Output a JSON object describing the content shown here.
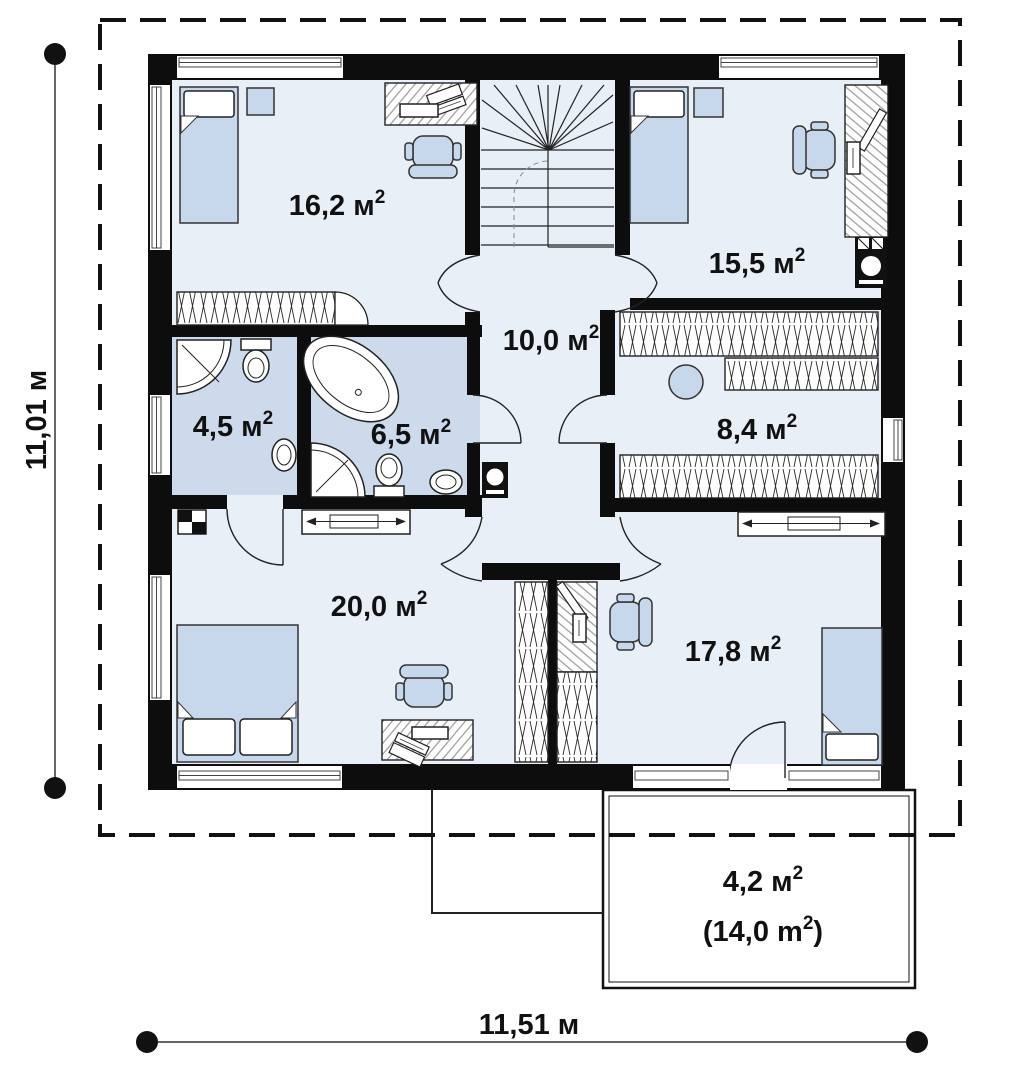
{
  "plan": {
    "type": "architectural-floor-plan",
    "rooms": [
      {
        "id": "bedroom-top-left",
        "area": "16,2 м²",
        "pre": "16,2 м",
        "sup": "2",
        "post": ""
      },
      {
        "id": "bedroom-top-right",
        "area": "15,5 м²",
        "pre": "15,5 м",
        "sup": "2",
        "post": ""
      },
      {
        "id": "hall",
        "area": "10,0 м²",
        "pre": "10,0 м",
        "sup": "2",
        "post": ""
      },
      {
        "id": "bathroom-small",
        "area": "4,5 м²",
        "pre": "4,5 м",
        "sup": "2",
        "post": ""
      },
      {
        "id": "bathroom-large",
        "area": "6,5 м²",
        "pre": "6,5 м",
        "sup": "2",
        "post": ""
      },
      {
        "id": "wardrobe-room",
        "area": "8,4 м²",
        "pre": "8,4 м",
        "sup": "2",
        "post": ""
      },
      {
        "id": "bedroom-bottom-left",
        "area": "20,0 м²",
        "pre": "20,0 м",
        "sup": "2",
        "post": ""
      },
      {
        "id": "bedroom-bottom-right",
        "area": "17,8 м²",
        "pre": "17,8 м",
        "sup": "2",
        "post": ""
      },
      {
        "id": "balcony-line-1",
        "area": "4,2 м²",
        "pre": "4,2 м",
        "sup": "2",
        "post": ""
      },
      {
        "id": "balcony-line-2",
        "area": "(14,0 m²)",
        "pre": "(14,0 m",
        "sup": "2",
        "post": ")"
      }
    ],
    "dimensions": {
      "vertical": {
        "label": "11,01 м"
      },
      "horizontal": {
        "label": "11,51 м"
      }
    },
    "colors": {
      "wall": "#0d0d0d",
      "room_fill": "#e9eff7",
      "bathroom_fill": "#ccdaec",
      "furniture_fill": "#c7d7ec",
      "background": "#ffffff"
    },
    "icons": [
      "bed-icon",
      "pillow-icon",
      "office-chair-icon",
      "desk-icon",
      "laptop-icon",
      "monitor-icon",
      "wardrobe-icon",
      "stairs-icon",
      "bathtub-icon",
      "shower-icon",
      "toilet-icon",
      "sink-icon",
      "washing-machine-icon",
      "boiler-icon",
      "nightstand-icon",
      "dresser-icon",
      "chimney-icon",
      "stool-icon",
      "window-icon",
      "door-icon",
      "dimension-dot-icon",
      "balcony-icon",
      "porch-outline-icon"
    ]
  }
}
